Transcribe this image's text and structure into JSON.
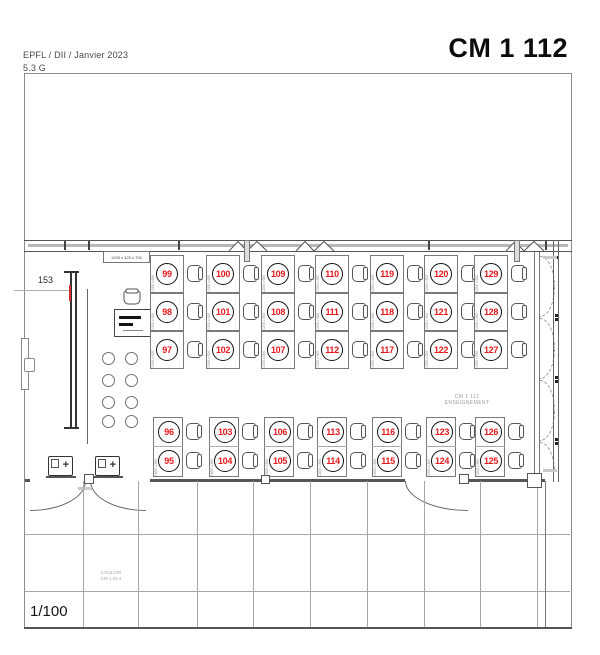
{
  "header": {
    "org": "EPFL / DII / Janvier 2023",
    "floor": "5.3 G",
    "title": "CM 1 112"
  },
  "plan": {
    "scale": "1/100",
    "dimension_label": "153",
    "lectern_size": "1200 x 420 x 700",
    "room_label_line1": "CM 1 112",
    "room_label_line2": "ENSEIGNEMENT",
    "corridor_label_line1": "COULOIR",
    "corridor_label_line2": "CM 1.04.4",
    "bin_symbol": "+"
  },
  "desks": {
    "single_label": "1200 x 600",
    "double_label": "1800 x 800"
  },
  "seating": {
    "top_columns": [
      {
        "x": 150,
        "seats": [
          "99",
          "98",
          "97"
        ]
      },
      {
        "x": 206,
        "seats": [
          "100",
          "101",
          "102"
        ]
      },
      {
        "x": 261,
        "seats": [
          "109",
          "108",
          "107"
        ]
      },
      {
        "x": 315,
        "seats": [
          "110",
          "111",
          "112"
        ]
      },
      {
        "x": 370,
        "seats": [
          "119",
          "118",
          "117"
        ]
      },
      {
        "x": 424,
        "seats": [
          "120",
          "121",
          "122"
        ]
      },
      {
        "x": 474,
        "seats": [
          "129",
          "128",
          "127"
        ]
      }
    ],
    "bottom_columns": [
      {
        "x": 153,
        "seats": [
          "96",
          "95"
        ]
      },
      {
        "x": 209,
        "seats": [
          "103",
          "104"
        ]
      },
      {
        "x": 264,
        "seats": [
          "106",
          "105"
        ]
      },
      {
        "x": 317,
        "seats": [
          "113",
          "114"
        ]
      },
      {
        "x": 372,
        "seats": [
          "116",
          "115"
        ]
      },
      {
        "x": 426,
        "seats": [
          "123",
          "124"
        ]
      },
      {
        "x": 475,
        "seats": [
          "126",
          "125"
        ]
      }
    ]
  },
  "colors": {
    "seat_number": "#e8191c",
    "wall": "#555555",
    "grid": "#a6a6a6",
    "faint_text": "#a8a8a8"
  }
}
